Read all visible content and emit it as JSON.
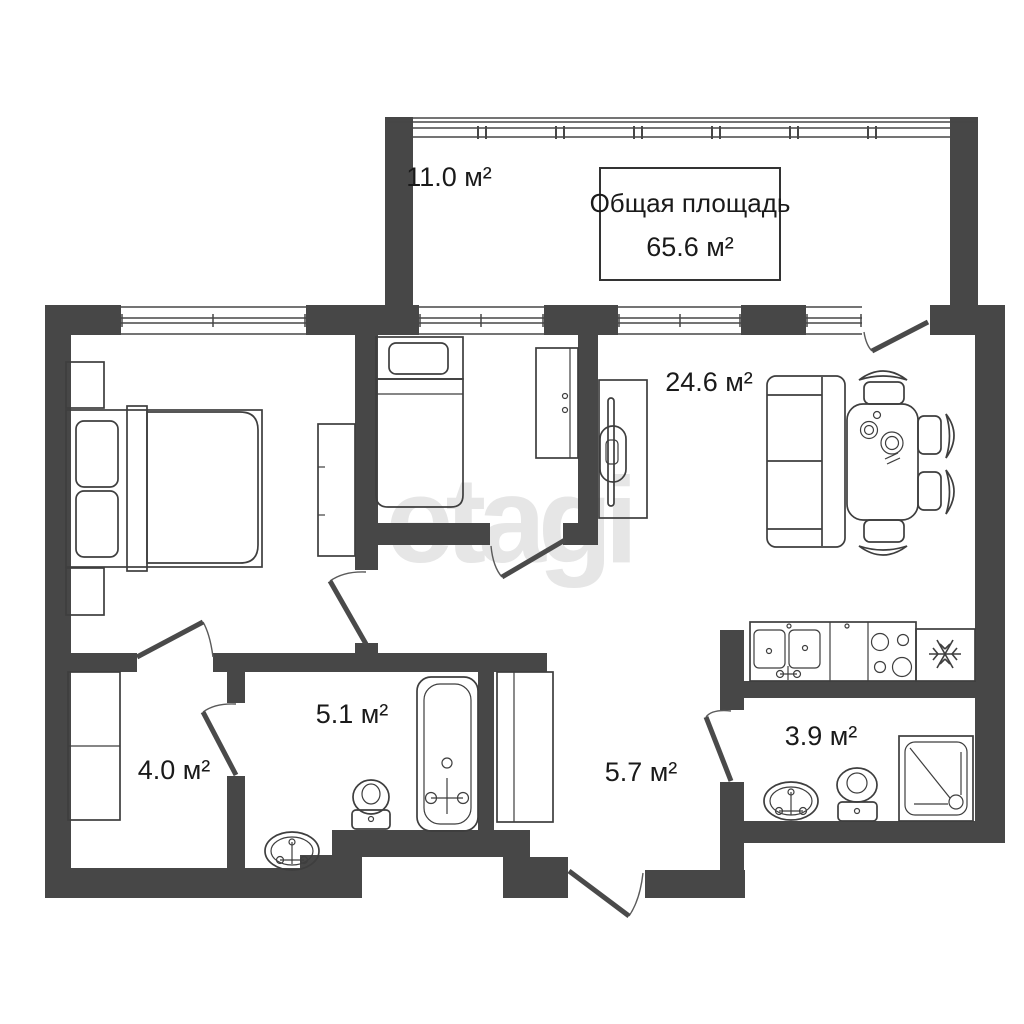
{
  "colors": {
    "background": "#ffffff",
    "wall": "#474747",
    "furniture_line": "#3e3e3e",
    "door": "#4a4a4a",
    "text": "#1a1a1a",
    "watermark": "#e6e6e6"
  },
  "watermark_text": "etagi",
  "total_area_box": {
    "title": "Общая площадь",
    "value": "65.6 м²"
  },
  "room_labels": [
    {
      "id": "balcony",
      "area": "11.0 м²"
    },
    {
      "id": "living-kitchen",
      "area": "24.6 м²"
    },
    {
      "id": "bathroom",
      "area": "5.1 м²"
    },
    {
      "id": "dressing-room",
      "area": "4.0 м²"
    },
    {
      "id": "hallway",
      "area": "5.7 м²"
    },
    {
      "id": "wc",
      "area": "3.9 м²"
    }
  ]
}
